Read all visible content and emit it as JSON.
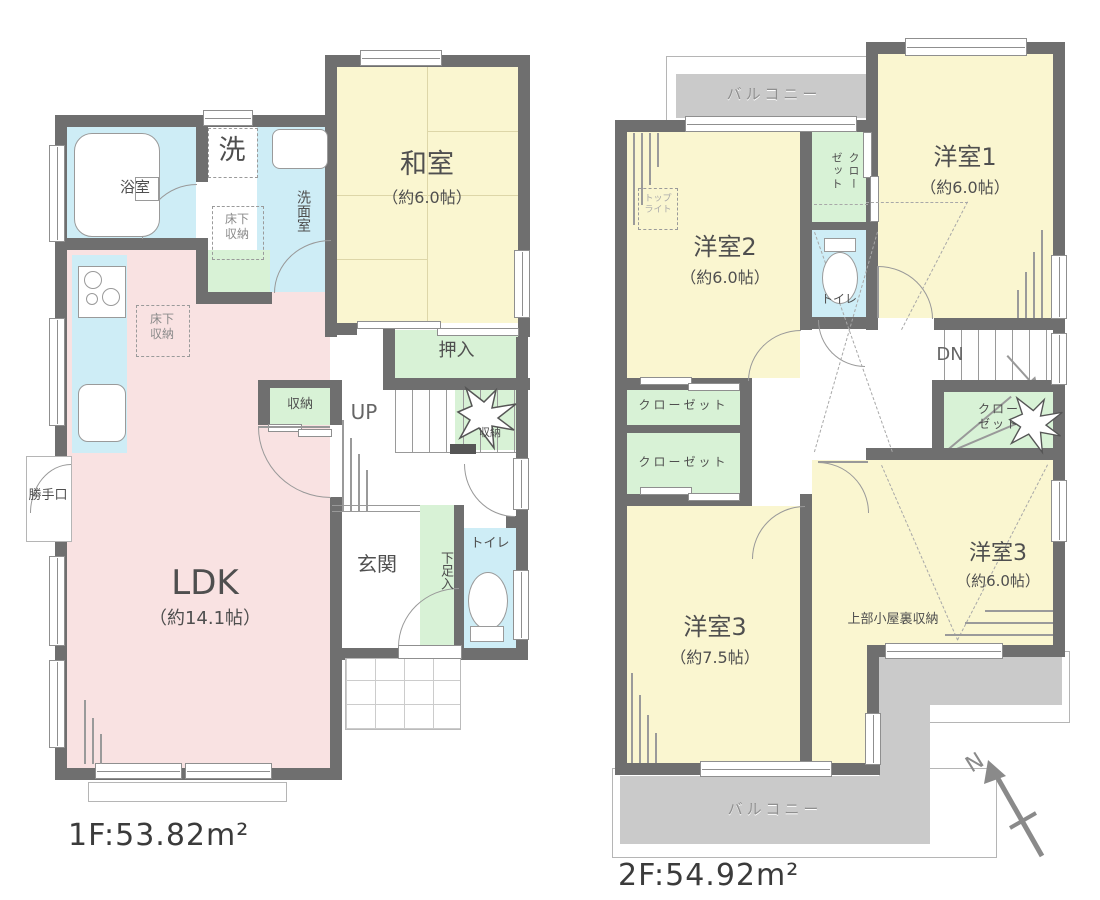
{
  "f1": {
    "area": "1F:53.82m²",
    "bath": "浴室",
    "laundry": "洗",
    "washroom": "洗面室",
    "underfloor_a": "床下収納",
    "underfloor_b": "床下収納",
    "washitsu": "和室",
    "washitsu_size": "（約6.0帖）",
    "oshiire": "押入",
    "closet": "収納",
    "up": "UP",
    "understairs": "収納",
    "ldk": "LDK",
    "ldk_size": "（約14.1帖）",
    "katteguchi": "勝手口",
    "genkan": "玄関",
    "shoebox": "下足入",
    "toilet": "トイレ"
  },
  "f2": {
    "area": "2F:54.92m²",
    "balcony_top": "バルコニー",
    "balcony_bottom": "バルコニー",
    "room1": "洋室1",
    "room1_size": "（約6.0帖）",
    "room2": "洋室2",
    "room2_size": "（約6.0帖）",
    "room3a": "洋室3",
    "room3a_size": "（約7.5帖）",
    "room3b": "洋室3",
    "room3b_size": "（約6.0帖）",
    "toplight": "トップライト",
    "closet_v": "クローゼット",
    "closet_l1": "クローゼット",
    "closet_l2": "クローゼット",
    "closet_r": "クローゼット",
    "toilet": "トイレ",
    "dn": "DN",
    "attic": "上部小屋裏収納"
  },
  "compass": {
    "n": "N"
  },
  "colors": {
    "wall": "#6f6f6f",
    "room_yellow": "#faf6d0",
    "room_pink": "#f9e2e2",
    "room_blue": "#ceedf6",
    "room_green": "#d8f2d6",
    "balcony_gray": "#cacaca"
  }
}
